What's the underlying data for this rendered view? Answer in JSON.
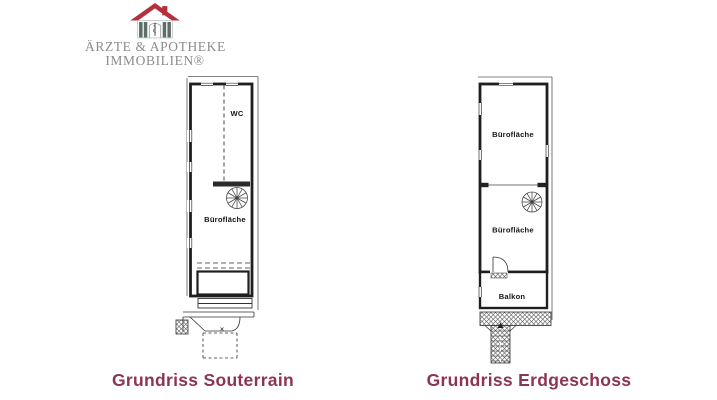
{
  "brand": {
    "line1": "ÄRZTE & APOTHEKE",
    "line2": "IMMOBILIEN®",
    "icon": "house-with-asclepius-staff-icon",
    "colors": {
      "roof": "#b5303d",
      "pillars": "#5d6d68",
      "text": "#8b8d8c"
    }
  },
  "souterrain": {
    "caption": "Grundriss Souterrain",
    "labels": {
      "wc": "WC",
      "office": "Bürofläche"
    }
  },
  "erdgeschoss": {
    "caption": "Grundriss Erdgeschoss",
    "labels": {
      "office_upper": "Bürofläche",
      "office_lower": "Bürofläche",
      "balcony": "Balkon"
    }
  },
  "icons": {
    "stairs": "spiral-staircase-icon",
    "door": "door-swing-icon",
    "external_stairs": "hatched-exterior-stairs"
  },
  "style": {
    "caption_color": "#8d3454",
    "plan_line_color": "#1f1f1f",
    "background": "#ffffff"
  }
}
